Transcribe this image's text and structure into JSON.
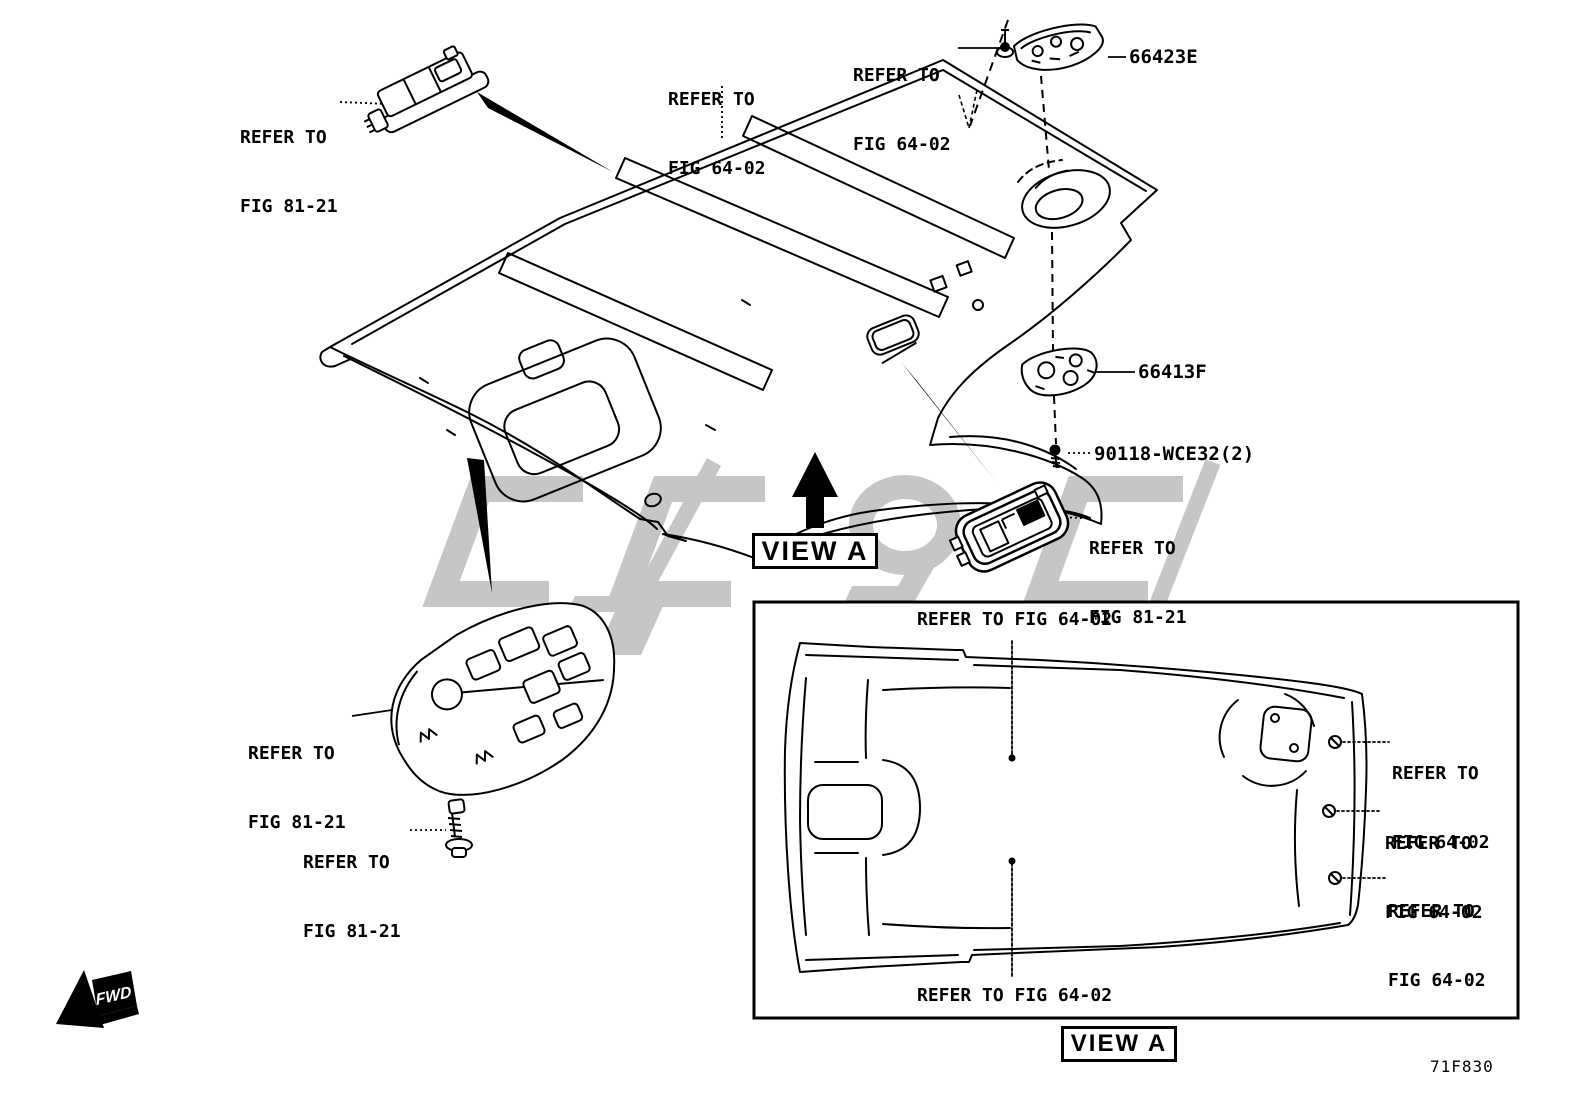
{
  "figure": {
    "code": "71F830"
  },
  "view_markers": {
    "main": "VIEW A",
    "detail": "VIEW A",
    "fwd": "FWD"
  },
  "part_numbers": {
    "rear_lamp": "66423E",
    "center_lamp": "66413F",
    "screw": "90118-WCE32(2)"
  },
  "callouts": {
    "front_map_lamp": {
      "line1": "REFER TO",
      "line2": "FIG 81-21"
    },
    "roof_trim_left": {
      "line1": "REFER TO",
      "line2": "FIG 64-02"
    },
    "roof_trim_clip": {
      "line1": "REFER TO",
      "line2": "FIG 64-02"
    },
    "dome_lamp": {
      "line1": "REFER TO",
      "line2": "FIG 81-21"
    },
    "overhead_console": {
      "line1": "REFER TO",
      "line2": "FIG 81-21"
    },
    "console_screw": {
      "line1": "REFER TO",
      "line2": "FIG 81-21"
    },
    "detail_top": "REFER TO FIG 64-02",
    "detail_bottom": "REFER TO FIG 64-02",
    "detail_right_1": {
      "line1": "REFER TO",
      "line2": "FIG 64-02"
    },
    "detail_right_2": {
      "line1": "REFER TO",
      "line2": "FIG 64-02"
    },
    "detail_right_3": {
      "line1": "REFER TO",
      "line2": "FIG 64-02"
    }
  },
  "colors": {
    "line": "#000000",
    "watermark": "#c6c6c6",
    "background": "#ffffff"
  }
}
